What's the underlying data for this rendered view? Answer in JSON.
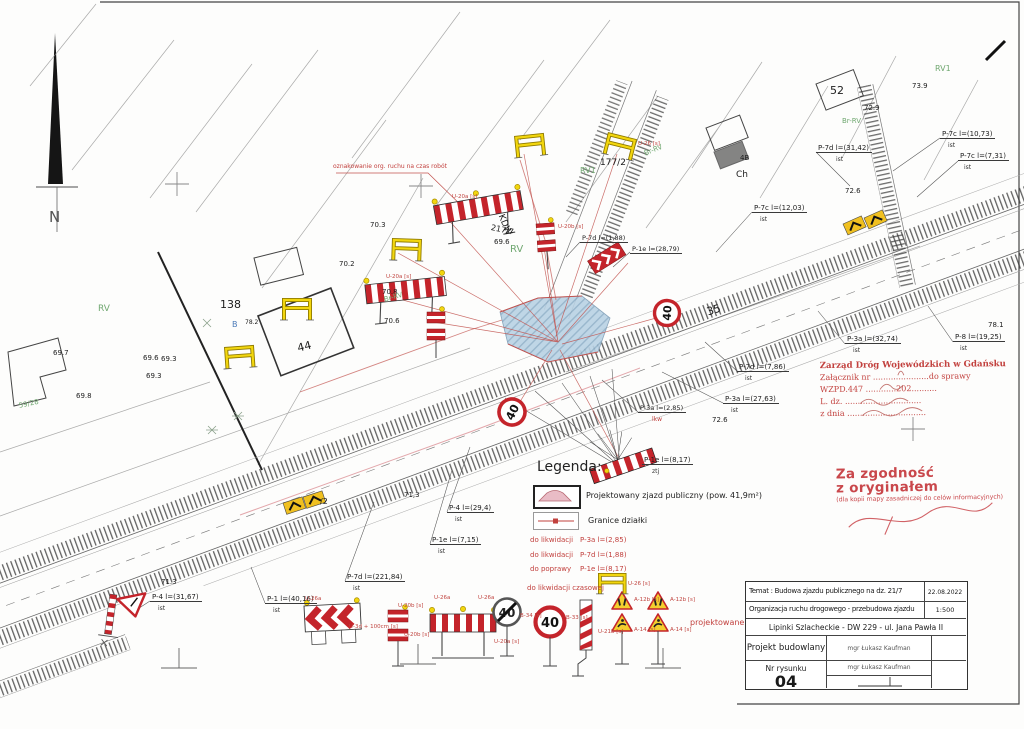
{
  "sheet": {
    "north": "N"
  },
  "signs": {
    "speed": "40"
  },
  "tags": {
    "ist": "ist",
    "lkw": "lkw",
    "ztj": "ztj"
  },
  "codes": {
    "u26a": "U-26a",
    "u26": "U-26 [s]",
    "u3d": "U-3d + 100cm [s]",
    "u20b": "U-20b [s]",
    "u20a": "U-20a [s]",
    "b33": "B-33 [s]",
    "b34": "B-34 [s]",
    "u21b": "U-21b [s]",
    "a12b": "A-12b [s]",
    "a14": "A-14 [s]"
  },
  "labels": {
    "n52": "52",
    "e72_9": "72.9",
    "e73_9": "73.9",
    "rv1": "RV1",
    "br_rv": "Br-RV",
    "p7c_10": "P-7c l=(10,73)",
    "p7c_7": "P-7c l=(7,31)",
    "p7d_31": "P-7d l=(31,42)",
    "p7c_12": "P-7c l=(12,03)",
    "p177_2": "177/2",
    "ch": "Ch",
    "b4": "4B",
    "e72_6": "72.6",
    "kdw": "KDW",
    "p217_7": "217/7",
    "e69_6": "69.6",
    "e70_3": "70.3",
    "e70_2": "70.2",
    "e70_8": "70.8",
    "e70_6": "70.6",
    "n138": "138",
    "bb": "B",
    "e78_2": "78.2",
    "n44": "44",
    "e69_7": "69.7",
    "e69_3": "69.3",
    "e69_8": "69.8",
    "g59_28": "59/28",
    "rv": "RV",
    "n35": "35",
    "p3a_32": "P-3a l=(32,74)",
    "p8_19": "P-8 l=(19,25)",
    "e78_1": "78.1",
    "p7d_7": "P-7d l=(7,86)",
    "p3a_27": "P-3a l=(27,63)",
    "p3a_2": "P-3a l=(2,85)",
    "p1e_28": "P-1e l=(28,79)",
    "p7d_1": "P-7d l=(1,88)",
    "p1e_8": "P-1e l=(8,17)",
    "p4_29": "P-4 l=(29,4)",
    "p1e_7": "P-1e l=(7,15)",
    "p7d_221": "P-7d l=(221,84)",
    "e71_3c": "71,3",
    "slash2": "/2",
    "e71_3": "71.3",
    "p4_31": "P-4 l=(31,67)",
    "p1_40": "P-1 l=(40,16)",
    "temp_note": "oznakowanie org. ruchu na czas robót",
    "projektowane": "projektowane"
  },
  "legend": {
    "title": "Legenda:",
    "driveway": "Projektowany zjazd publiczny (pow. 41,9m²)",
    "boundary": "Granice działki",
    "lkw_tag": "do likwidacji",
    "pop_tag": "do poprawy",
    "tmp_tag": "do likwidacji czasowej",
    "val1": "P-3a l=(2,85)",
    "val2": "P-7d l=(1,88)",
    "val3": "P-1e l=(8,17)"
  },
  "stamp_zdw": {
    "l1": "Zarząd Dróg Wojewódzkich w Gdańsku",
    "l2": "Załącznik nr ......................do sprawy",
    "l3": "WZPD.447 ............202..........",
    "l4": "L. dz. ..............................",
    "l5": "z dnia ..............................."
  },
  "stamp_copy": {
    "l1": "Za zgodność",
    "l2": "z oryginałem",
    "l3": "(dla kopii mapy zasadniczej do celów informacyjnych)"
  },
  "titleblock": {
    "temat": "Temat : Budowa zjazdu publicznego na dz. 21/7",
    "date": "22.08.2022",
    "org": "Organizacja ruchu drogowego - przebudowa zjazdu",
    "scale": "1:500",
    "location": "Lipinki Szlacheckie - DW 229 - ul. Jana Pawła II",
    "proj_label": "Projekt budowlany",
    "author": "mgr Łukasz Kaufman",
    "author2": "mgr Łukasz Kaufman",
    "nr_label": "Nr rysunku",
    "nr": "04"
  }
}
